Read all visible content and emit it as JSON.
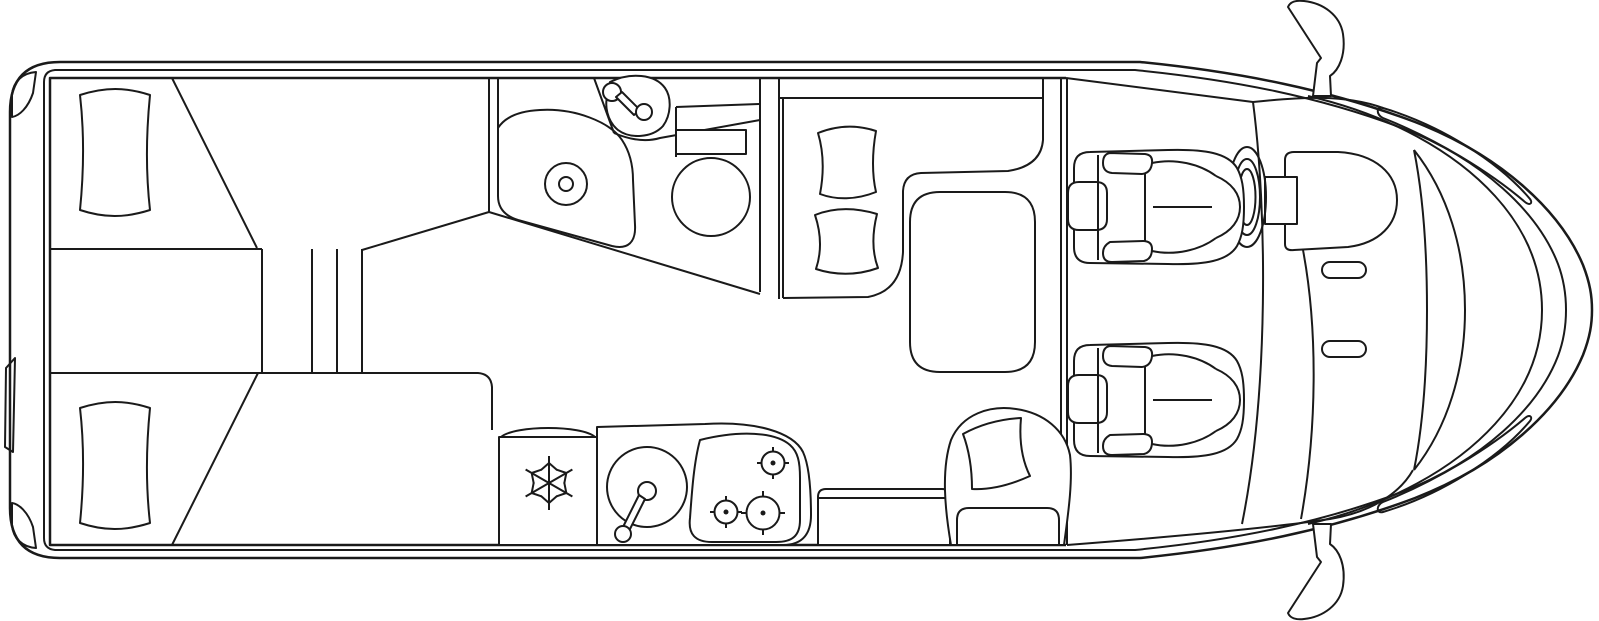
{
  "colors": {
    "background": "#ffffff",
    "line": "#1a1a1a"
  },
  "diagram": {
    "kind": "motorhome-floor-plan-top-view-line-drawing",
    "orientation": "rear-left-front-right",
    "regions": [
      {
        "name": "rear-bedroom",
        "items": [
          "single-bed-top",
          "bed-pillow-top",
          "single-bed-bottom",
          "bed-pillow-bottom",
          "center-steps"
        ]
      },
      {
        "name": "bathroom",
        "items": [
          "shower-tray-with-drain",
          "washbasin-with-faucet",
          "toilet-with-cistern"
        ]
      },
      {
        "name": "kitchen",
        "items": [
          "fridge-with-snowflake",
          "round-sink-with-faucet",
          "hob-with-three-burners"
        ]
      },
      {
        "name": "dinette",
        "items": [
          "l-shaped-bench",
          "seat-cushion",
          "seat-cushion",
          "dinette-table"
        ]
      },
      {
        "name": "lounge",
        "items": [
          "side-bench",
          "armchair-with-cushion"
        ]
      },
      {
        "name": "cab",
        "items": [
          "driver-seat",
          "steering-wheel",
          "passenger-seat",
          "dashboard",
          "windshield",
          "side-mirror-top",
          "side-mirror-bottom"
        ]
      }
    ]
  }
}
